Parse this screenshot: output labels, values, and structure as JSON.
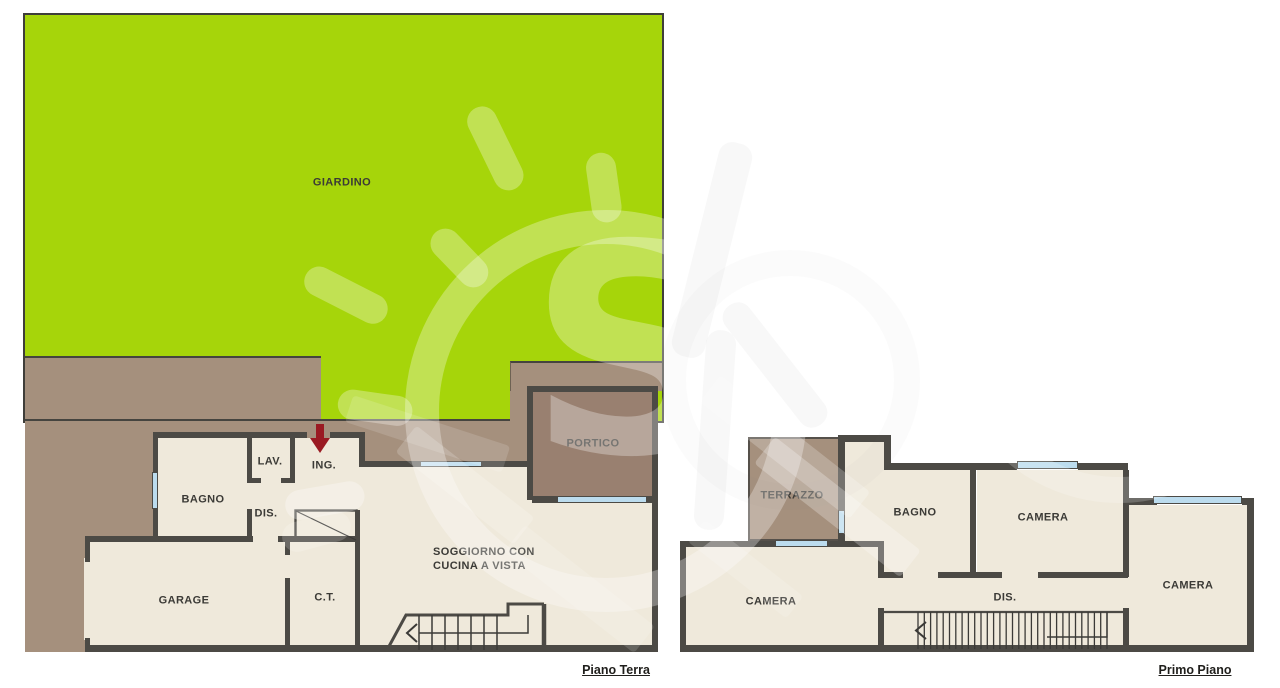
{
  "document": {
    "type": "real-estate floor plan",
    "floors": [
      "Piano Terra",
      "Primo Piano"
    ]
  },
  "plans": {
    "ground": {
      "name": "Piano Terra",
      "rooms": {
        "giardino": "GIARDINO",
        "portico": "PORTICO",
        "lav": "LAV.",
        "ing": "ING.",
        "bagno": "BAGNO",
        "dis": "DIS.",
        "garage": "GARAGE",
        "ct": "C.T.",
        "soggiorno_line1": "SOGGIORNO CON",
        "soggiorno_line2": "CUCINA A VISTA"
      }
    },
    "first": {
      "name": "Primo Piano",
      "rooms": {
        "terrazzo": "TERRAZZO",
        "bagno": "BAGNO",
        "camera_top": "CAMERA",
        "camera_right": "CAMERA",
        "camera_left": "CAMERA",
        "dis": "DIS."
      }
    }
  },
  "colors": {
    "garden_green": "#a6d50a",
    "paving_brown": "#a5907d",
    "portico_floor_brown": "#998070",
    "interior_floor_cream": "#efe9db",
    "wall_dark": "#4c4a45",
    "window_blue": "#bcdcee",
    "entrance_arrow_red": "#9a1a22",
    "label_text": "#3b3a36"
  },
  "icons": {
    "entrance_arrow": "red arrow pointing down at entrance (ING.)",
    "stairs_ground": "staircase with left chevron direction arrow",
    "stairs_first": "staircase with left chevron direction arrow",
    "watermark": "translucent sun logo watermark"
  }
}
